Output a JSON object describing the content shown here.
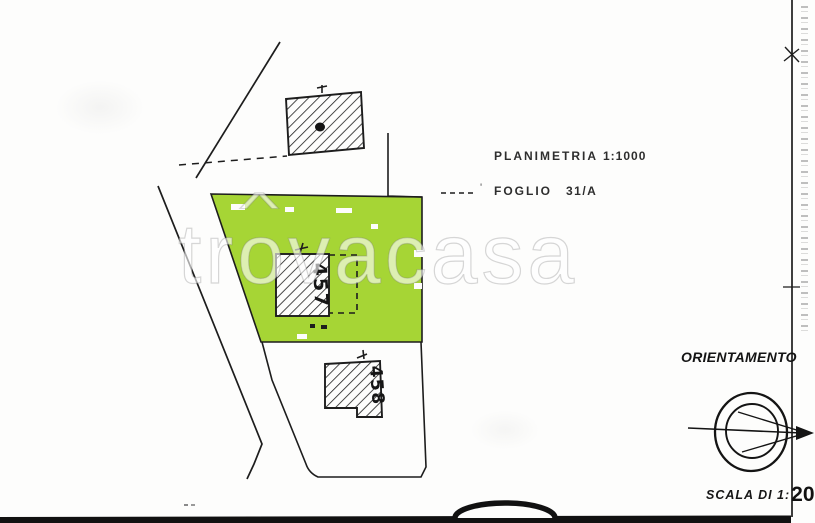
{
  "header": {
    "planimetria_label": "PLANIMETRIA",
    "planimetria_value": "1:1000",
    "foglio_label": "FOGLIO",
    "foglio_value": "31/A",
    "pencil_tick": "'"
  },
  "watermark": {
    "pre": "tr",
    "o": "o",
    "roof": "^",
    "post": "vacasa"
  },
  "map": {
    "highlighted_parcel_number": "457",
    "lower_parcel_number": "458",
    "highlight_color": "#a6d535"
  },
  "orientation": {
    "label": "ORIENTAMENTO"
  },
  "scale": {
    "label": "SCALA DI 1:",
    "value": "20"
  },
  "colors": {
    "ink": "#1d1d1d",
    "paper": "#fdfdfc"
  }
}
